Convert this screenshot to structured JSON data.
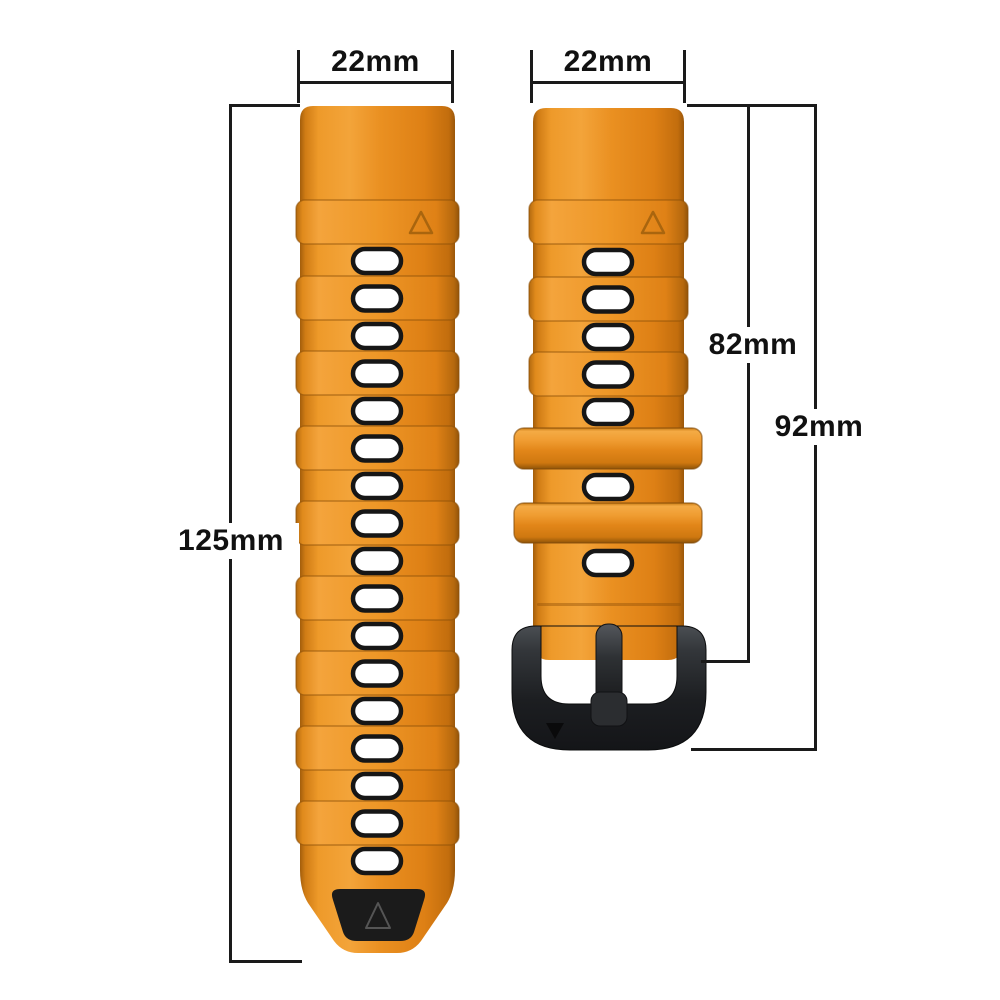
{
  "annotations": {
    "left_strap_width": "22mm",
    "right_strap_width": "22mm",
    "left_strap_length": "125mm",
    "right_strap_length_to_buckle": "82mm",
    "right_strap_length_total": "92mm"
  },
  "colors": {
    "strap_orange": "#E88C1C",
    "strap_orange_light": "#F3A339",
    "strap_orange_dark": "#B96C10",
    "hole_fill": "#FFFFFF",
    "hole_outline": "#161616",
    "keeper_orange": "#E28619",
    "buckle_black": "#1E2023",
    "tip_patch_black": "#1B1B1B",
    "dimension_line": "#1A1A1A"
  },
  "left_strap": {
    "hole_count": 17
  },
  "right_strap": {
    "holes_upper": 5,
    "holes_between_keepers": 1,
    "holes_below_keepers": 1,
    "keeper_count": 2
  }
}
